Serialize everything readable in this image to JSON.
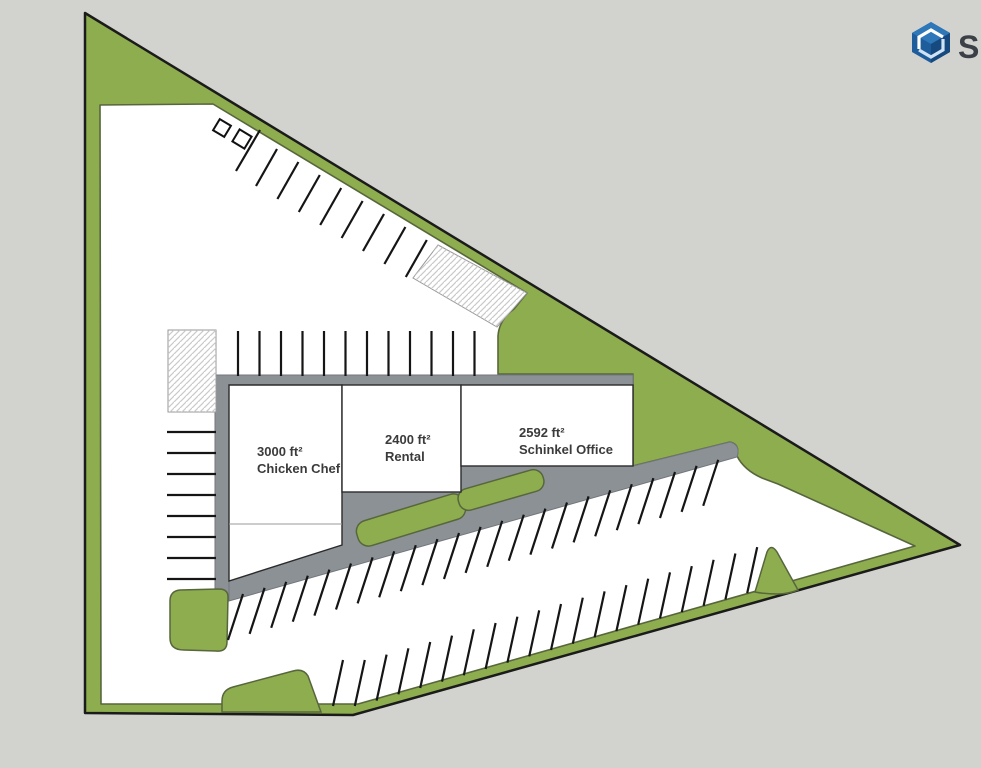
{
  "plan": {
    "buildings": [
      {
        "area": "3000 ft²",
        "name": "Chicken Chef"
      },
      {
        "area": "2400 ft²",
        "name": "Rental"
      },
      {
        "area": "2592 ft²",
        "name": "Schinkel Office"
      }
    ]
  },
  "logo": {
    "text": "Sk"
  },
  "colors": {
    "grass": "#8dad4f",
    "grass_edge": "#57663c",
    "pavement_band": "#8c9196",
    "background": "#d2d2ce",
    "site_outline": "#1b1b1b",
    "logo_blue": "#1e5d9c"
  }
}
